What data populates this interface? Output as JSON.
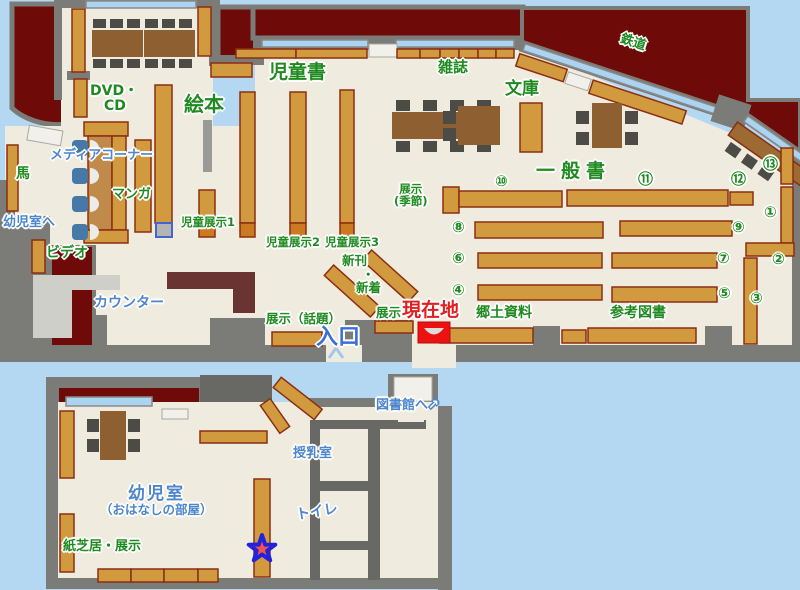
{
  "title": "library-floor-map",
  "colors": {
    "bg": "#b5d8f2",
    "outside": "#6e0a08",
    "wall": "#7b7b78",
    "wall_dark": "#686865",
    "floor": "#efecdf",
    "shelf": "#d29a3e",
    "shelf_border": "#8b2e12",
    "shelf_cap": "#cc7a22",
    "table": "#8e5f30",
    "chair": "#4d4b45",
    "window": "#abd4f2",
    "counter": "#6a3432",
    "media_desk": "#c08a4a",
    "media_seat": "#4679a8",
    "light_area": "#cfcfca",
    "sign": "#f2f0ea",
    "marker_red": "#ee1111",
    "star_fill": "#ef5350",
    "star_border": "#2222dd",
    "desk_diag": "#9b6b33",
    "text_green": "#1f8a1f",
    "text_blue": "#4d86cc",
    "text_blue_dark": "#3a6fd8",
    "text_red": "#e02020"
  },
  "labels": {
    "dvd": "DVD・",
    "cd": "CD",
    "ehon": "絵本",
    "jidosho": "児童書",
    "zasshi": "雑誌",
    "bunko": "文庫",
    "tetsudo": "鉄道",
    "ippansho": "一般書",
    "uma": "馬",
    "media_corner": "メディアコーナー",
    "manga": "マンガ",
    "to_yojishitsu": "幼児室へ",
    "video": "ビデオ",
    "counter": "カウンター",
    "jido_tenji1": "児童展示1",
    "jido_tenji2": "児童展示2",
    "jido_tenji3": "児童展示3",
    "tenji_kisetsu_1": "展示",
    "tenji_kisetsu_2": "(季節)",
    "shinkan": "新刊",
    "nakaguro": "・",
    "shinchaku": "新着",
    "tenji_wadai": "展示（話題）",
    "tenji": "展示",
    "genzaichi": "現在地",
    "iriguchi": "入口",
    "kyodo_shiryo": "郷土資料",
    "sanko_tosho": "参考図書",
    "to_toshokan": "図書館へ",
    "arrow_ne": "↗",
    "junyushitsu": "授乳室",
    "toire": "トイレ",
    "yojishitsu": "幼児室",
    "ohanashi": "（おはなしの部屋）",
    "kamishibai_tenji": "紙芝居・展示"
  },
  "numbers": {
    "n1": "①",
    "n2": "②",
    "n3": "③",
    "n4": "④",
    "n5": "⑤",
    "n6": "⑥",
    "n7": "⑦",
    "n8": "⑧",
    "n9": "⑨",
    "n10": "⑩",
    "n11": "⑪",
    "n12": "⑫",
    "n13": "⑬"
  }
}
